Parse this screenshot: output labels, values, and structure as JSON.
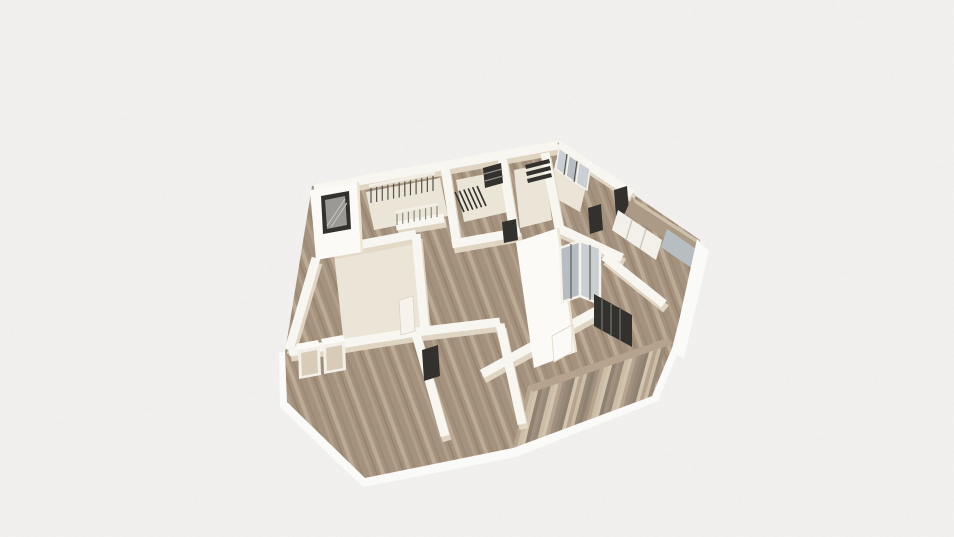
{
  "scene": {
    "app": "3d-floor-plan-viewer",
    "view": "perspective-dollhouse-render",
    "content": "apartment floor plan with wood floors, white walls, balconies",
    "visible_text": ""
  },
  "palette": {
    "background": "#f1f0ee",
    "grid_line": "#e8e6e2",
    "wall_white": "#f8f6f0",
    "wall_bright": "#fbfaf7",
    "wall_shadow": "#e3d9c6",
    "wall_cream": "#ede5d4",
    "floor_wood": "#a5927e",
    "floor_light": "#ebe5d7",
    "fascia": "#fafaf8",
    "frame_dark": "#33312d",
    "frame_mid": "#55524b",
    "glass": "#b7bec2",
    "glass_light": "#c9cfd2",
    "railing_gray": "#8d897f",
    "slat_cap": "#b5a38d",
    "tan_wall": "#ab9a85",
    "tan_top": "#cdbfa9",
    "closet_body": "#f3f0e9",
    "closet_door": "#d8ccb8",
    "door_leaf": "#f6f3ec",
    "pane_gray": "#9a9994"
  },
  "railings": {
    "stair_upper": {
      "count": 12
    },
    "stair_lower": {
      "count": 8
    },
    "stair_hatch": {
      "count": 6
    },
    "balcony_slats": {
      "count": 34,
      "colors": [
        "#b6a48e",
        "#8f8170",
        "#cbbda6",
        "#a09080",
        "#d2c5af",
        "#978977"
      ]
    }
  },
  "features": [
    "dark-framed-window",
    "stair-void-railing",
    "stair-guard-rail",
    "bathroom-block",
    "glazed-wall",
    "sliding-glass-door",
    "glass-partition",
    "balcony-wood-slat-railing",
    "right-balcony-glass",
    "wardrobe-closets",
    "interior-dark-doors"
  ]
}
